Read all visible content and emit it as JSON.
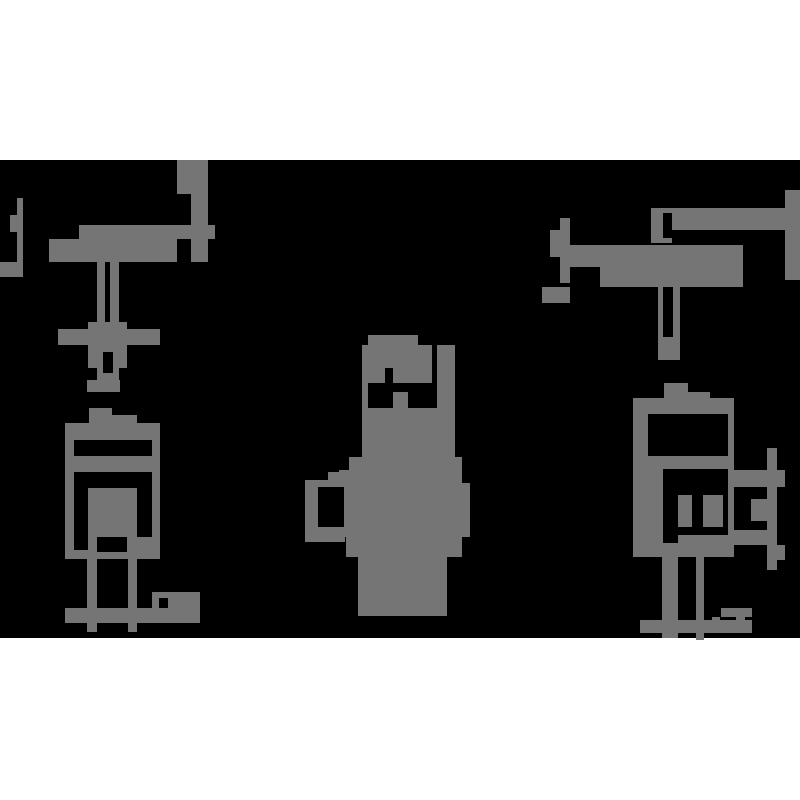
{
  "image": {
    "width": 800,
    "height": 800,
    "page_background": "#ffffff",
    "ink_color": "#757575",
    "hole_color": "#000000",
    "band": {
      "x": 0,
      "y": 160,
      "width": 800,
      "height": 478,
      "color": "#000000"
    }
  },
  "figures": [
    {
      "name": "figure-left-stand-machine",
      "rects": [
        [
          177,
          160,
          31,
          34
        ],
        [
          191,
          194,
          17,
          68
        ],
        [
          177,
          225,
          38,
          14
        ],
        [
          79,
          225,
          98,
          14
        ],
        [
          49,
          239,
          128,
          23
        ],
        [
          17,
          198,
          6,
          79
        ],
        [
          10,
          215,
          13,
          17
        ],
        [
          0,
          262,
          20,
          15
        ],
        [
          97,
          262,
          8,
          60
        ],
        [
          110,
          262,
          9,
          60
        ],
        [
          58,
          329,
          102,
          16
        ],
        [
          88,
          322,
          39,
          46
        ],
        [
          97,
          368,
          22,
          24
        ],
        [
          87,
          380,
          33,
          12
        ],
        [
          89,
          408,
          23,
          8
        ],
        [
          89,
          415,
          48,
          9
        ],
        [
          65,
          423,
          95,
          17
        ],
        [
          65,
          440,
          9,
          119
        ],
        [
          152,
          440,
          8,
          119
        ],
        [
          65,
          456,
          95,
          16
        ],
        [
          88,
          488,
          49,
          64
        ],
        [
          127,
          537,
          26,
          15
        ],
        [
          65,
          550,
          95,
          9
        ],
        [
          87,
          559,
          10,
          73
        ],
        [
          128,
          559,
          9,
          73
        ],
        [
          65,
          608,
          135,
          15
        ],
        [
          152,
          592,
          48,
          16
        ]
      ],
      "holes": [
        [
          103,
          352,
          10,
          21
        ],
        [
          97,
          537,
          30,
          15
        ],
        [
          159,
          598,
          9,
          10
        ]
      ]
    },
    {
      "name": "figure-center-silhouette",
      "rects": [
        [
          368,
          335,
          50,
          10
        ],
        [
          362,
          345,
          93,
          112
        ],
        [
          349,
          457,
          113,
          13
        ],
        [
          339,
          470,
          123,
          13
        ],
        [
          328,
          472,
          16,
          11
        ],
        [
          305,
          480,
          40,
          62
        ],
        [
          344,
          483,
          126,
          54
        ],
        [
          346,
          537,
          116,
          20
        ],
        [
          358,
          557,
          89,
          59
        ]
      ],
      "holes": [
        [
          432,
          345,
          5,
          63
        ],
        [
          385,
          368,
          8,
          15
        ],
        [
          368,
          383,
          25,
          25
        ],
        [
          408,
          383,
          24,
          25
        ],
        [
          393,
          383,
          15,
          9
        ],
        [
          318,
          487,
          26,
          40
        ]
      ]
    },
    {
      "name": "figure-right-stand-machine",
      "rects": [
        [
          655,
          208,
          145,
          22
        ],
        [
          785,
          190,
          15,
          90
        ],
        [
          651,
          208,
          21,
          35
        ],
        [
          563,
          245,
          180,
          22
        ],
        [
          600,
          257,
          143,
          30
        ],
        [
          560,
          218,
          10,
          65
        ],
        [
          550,
          230,
          20,
          27
        ],
        [
          542,
          287,
          28,
          16
        ],
        [
          658,
          287,
          22,
          73
        ],
        [
          664,
          383,
          24,
          15
        ],
        [
          664,
          392,
          46,
          6
        ],
        [
          633,
          398,
          101,
          16
        ],
        [
          633,
          414,
          15,
          143
        ],
        [
          728,
          414,
          6,
          143
        ],
        [
          633,
          456,
          101,
          13
        ],
        [
          648,
          469,
          15,
          74
        ],
        [
          678,
          495,
          14,
          32
        ],
        [
          703,
          495,
          20,
          32
        ],
        [
          678,
          535,
          56,
          8
        ],
        [
          633,
          543,
          101,
          14
        ],
        [
          728,
          470,
          57,
          17
        ],
        [
          767,
          448,
          10,
          122
        ],
        [
          777,
          545,
          8,
          15
        ],
        [
          751,
          499,
          16,
          22
        ],
        [
          728,
          530,
          49,
          15
        ],
        [
          662,
          557,
          16,
          81
        ],
        [
          696,
          557,
          8,
          83
        ],
        [
          640,
          620,
          112,
          13
        ],
        [
          721,
          608,
          31,
          9
        ],
        [
          712,
          617,
          8,
          8
        ],
        [
          736,
          617,
          9,
          8
        ]
      ],
      "holes": [
        [
          663,
          213,
          9,
          25
        ],
        [
          663,
          287,
          10,
          50
        ]
      ]
    }
  ]
}
